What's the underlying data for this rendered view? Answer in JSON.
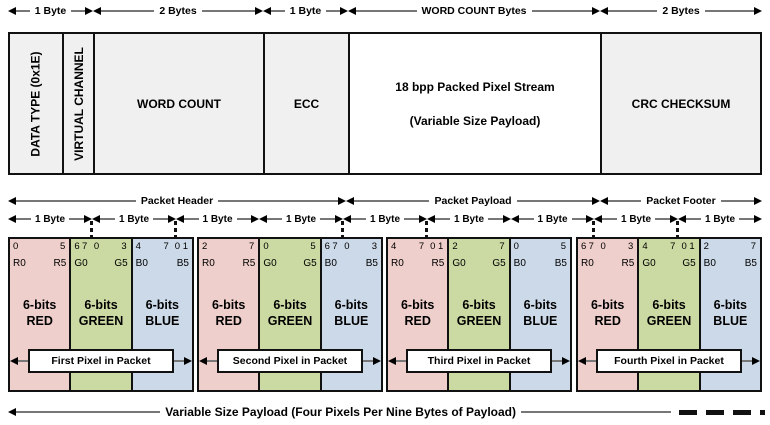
{
  "colors": {
    "red": "#eecfcb",
    "green": "#cbd9a2",
    "blue": "#ccd9e8",
    "field_bg": "#f0f0f0",
    "payload_bg": "#ffffff"
  },
  "top_byte_arrows": [
    {
      "label": "1 Byte"
    },
    {
      "label": "2 Bytes"
    },
    {
      "label": "1 Byte"
    },
    {
      "label": "WORD COUNT Bytes"
    },
    {
      "label": "2 Bytes"
    }
  ],
  "fields": {
    "data_type": "DATA TYPE (0x1E)",
    "virtual_channel": "VIRTUAL CHANNEL",
    "word_count": "WORD COUNT",
    "ecc": "ECC",
    "payload_line1": "18 bpp Packed Pixel Stream",
    "payload_line2": "(Variable Size Payload)",
    "crc": "CRC CHECKSUM"
  },
  "sections": [
    {
      "label": "Packet Header"
    },
    {
      "label": "Packet Payload"
    },
    {
      "label": "Packet Footer"
    }
  ],
  "byte_arrows": [
    {
      "label": "1 Byte"
    },
    {
      "label": "1 Byte"
    },
    {
      "label": "1 Byte"
    },
    {
      "label": "1 Byte"
    },
    {
      "label": "1 Byte"
    },
    {
      "label": "1 Byte"
    },
    {
      "label": "1 Byte"
    },
    {
      "label": "1 Byte"
    },
    {
      "label": "1 Byte"
    }
  ],
  "pixels": {
    "groups": [
      {
        "label": "First Pixel in Packet",
        "boxes": [
          {
            "bits": [
              "0",
              "",
              "",
              "5"
            ],
            "range": [
              "R0",
              "R5"
            ],
            "label_line1": "6-bits",
            "label_line2": "RED"
          },
          {
            "bits": [
              "6",
              "7",
              "0",
              "3"
            ],
            "range": [
              "G0",
              "G5"
            ],
            "label_line1": "6-bits",
            "label_line2": "GREEN"
          },
          {
            "bits": [
              "4",
              "7",
              "0",
              "1"
            ],
            "range": [
              "B0",
              "B5"
            ],
            "label_line1": "6-bits",
            "label_line2": "BLUE"
          }
        ]
      },
      {
        "label": "Second Pixel in Packet",
        "boxes": [
          {
            "bits": [
              "2",
              "",
              "",
              "7"
            ],
            "range": [
              "R0",
              "R5"
            ],
            "label_line1": "6-bits",
            "label_line2": "RED"
          },
          {
            "bits": [
              "0",
              "",
              "",
              "5"
            ],
            "range": [
              "G0",
              "G5"
            ],
            "label_line1": "6-bits",
            "label_line2": "GREEN"
          },
          {
            "bits": [
              "6",
              "7",
              "0",
              "3"
            ],
            "range": [
              "B0",
              "B5"
            ],
            "label_line1": "6-bits",
            "label_line2": "BLUE"
          }
        ]
      },
      {
        "label": "Third Pixel in Packet",
        "boxes": [
          {
            "bits": [
              "4",
              "7",
              "0",
              "1"
            ],
            "range": [
              "R0",
              "R5"
            ],
            "label_line1": "6-bits",
            "label_line2": "RED"
          },
          {
            "bits": [
              "2",
              "",
              "",
              "7"
            ],
            "range": [
              "G0",
              "G5"
            ],
            "label_line1": "6-bits",
            "label_line2": "GREEN"
          },
          {
            "bits": [
              "0",
              "",
              "",
              "5"
            ],
            "range": [
              "B0",
              "B5"
            ],
            "label_line1": "6-bits",
            "label_line2": "BLUE"
          }
        ]
      },
      {
        "label": "Fourth Pixel in Packet",
        "boxes": [
          {
            "bits": [
              "6",
              "7",
              "0",
              "3"
            ],
            "range": [
              "R0",
              "R5"
            ],
            "label_line1": "6-bits",
            "label_line2": "RED"
          },
          {
            "bits": [
              "4",
              "7",
              "0",
              "1"
            ],
            "range": [
              "G0",
              "G5"
            ],
            "label_line1": "6-bits",
            "label_line2": "GREEN"
          },
          {
            "bits": [
              "2",
              "",
              "",
              "7"
            ],
            "range": [
              "B0",
              "B5"
            ],
            "label_line1": "6-bits",
            "label_line2": "BLUE"
          }
        ]
      }
    ]
  },
  "footer": {
    "label": "Variable Size Payload  (Four Pixels Per Nine Bytes of Payload)"
  }
}
